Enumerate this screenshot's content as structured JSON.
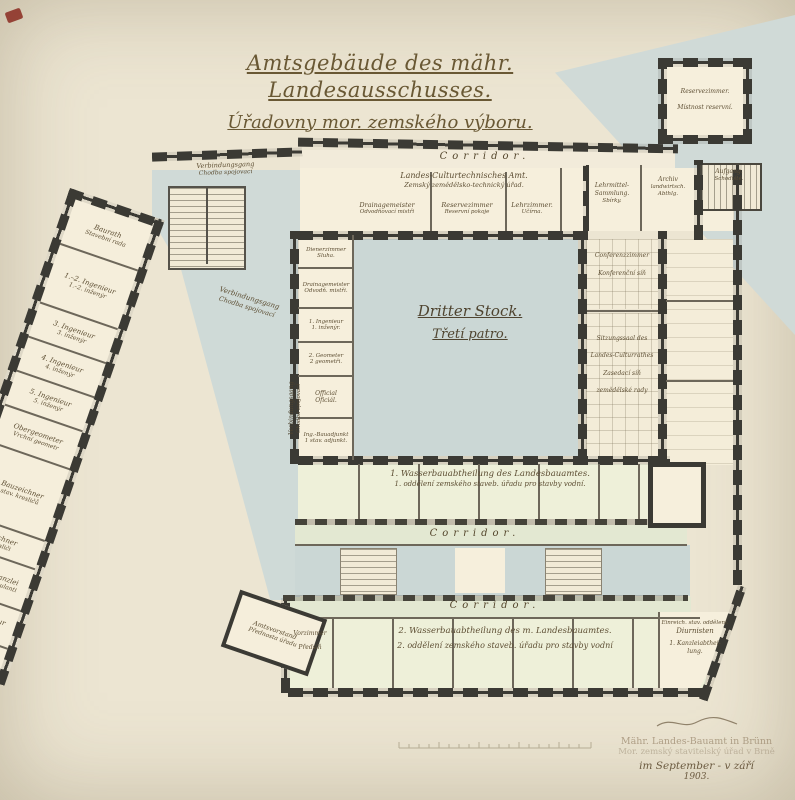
{
  "title": {
    "de": "Amtsgebäude des mähr. Landesausschusses.",
    "cz": "Úřadovny mor. zemského výboru."
  },
  "floor": {
    "de": "Dritter Stock.",
    "cz": "Třetí patro."
  },
  "corridor_label": "Corridor.",
  "gang": {
    "de": "Verbindungsgang",
    "cz": "Chodba spojovací"
  },
  "top_rooms": {
    "office_de": "Landes-Culturtechnisches Amt.",
    "office_cz": "Zemský zemědělsko-technický úřad.",
    "cells": [
      {
        "de": "Drainagemeister",
        "cz": "Odvodňovací mistři"
      },
      {
        "de": "Reservezimmer",
        "cz": "Reservní pokoje"
      },
      {
        "de": "Lehrzimmer.",
        "cz": "Učírna."
      },
      {
        "de": "Lehrmittel- Sammlung.",
        "cz": "Sbírky."
      }
    ],
    "archiv": {
      "l1": "Archiv",
      "l2": "landwirtsch.",
      "l3": "Abthlg."
    },
    "stair": {
      "de": "Aufgang.",
      "cz": "Schodiště."
    }
  },
  "annex": {
    "de": "Reservezimmer.",
    "cz": "Místnost reservní."
  },
  "right_wing": {
    "conference": {
      "de": "Conferenzzimmer",
      "cz": "Konferenční síň"
    },
    "hall": {
      "l1": "Sitzungssaal des",
      "l2": "Landes-Culturrathes",
      "l3": "Zasedací síň",
      "l4": "zemědělské rady"
    }
  },
  "inner_rooms": [
    {
      "de": "Dienerzimmer",
      "cz": "Sluha."
    },
    {
      "de": "Drainagemeister",
      "cz": "Odvodň. mistři."
    },
    {
      "de": "1. Ingenieur",
      "cz": "1. inženýr."
    },
    {
      "de": "2. Geometer",
      "cz": "2 geometři."
    },
    {
      "de": "Official",
      "cz": "Oficiál."
    },
    {
      "de": "Ing.-Bauadjunkt",
      "cz": "1 stav. adjunkt."
    }
  ],
  "wing_rooms": [
    {
      "de": "Baurath",
      "cz": "Stavební rada"
    },
    {
      "de": "1.–2. Ingenieur",
      "cz": "1.–2. inženýr"
    },
    {
      "de": "3. Ingenieur",
      "cz": "3. inženýr"
    },
    {
      "de": "4. Ingenieur",
      "cz": "4. inženýr"
    },
    {
      "de": "5. Ingenieur",
      "cz": "5. inženýr"
    },
    {
      "de": "Obergeometer",
      "cz": "Vrchní geometr"
    },
    {
      "de": "6 Bauzeichner",
      "cz": "6 stav. kresličů"
    },
    {
      "de": "Zeichner",
      "cz": "Kresliči"
    },
    {
      "de": "Manipul.-Kanzlei",
      "cz": "Kancel. manipulanti"
    },
    {
      "de": "1 jüng. Ingenieur",
      "cz": "Bauadjunkt"
    },
    {
      "de": "Bauzeichner",
      "cz": "1 stav. kreslič"
    }
  ],
  "bands": {
    "band1_de": "1. Wasserbauabtheilung des Landesbauamtes.",
    "band1_cz": "1. oddělení zemského staveb. úřadu pro stavby vodní.",
    "band2_de": "2. Wasserbauabtheilung des m. Landesbauamtes.",
    "band2_cz": "2. oddělení zemského staveb. úřadu pro stavby vodní"
  },
  "vorzimmer": {
    "de": "Vorzimmer",
    "cz": "Předsíň"
  },
  "sw_corner": {
    "de": "Amtsvorstand",
    "cz": "Přednosta úřadu"
  },
  "se_rooms": {
    "l1": "Einreich. stav. oddělení.",
    "l2": "Diurnisten",
    "l3": "1. Kanzleiabthei-",
    "l4": "lung."
  },
  "stamp": {
    "l1": "Mähr. Landes-Bauamt in Brünn",
    "l2": "Mor. zemský stavitelský úřad v Brně",
    "l3": "im September - v září",
    "l4": "1903."
  }
}
